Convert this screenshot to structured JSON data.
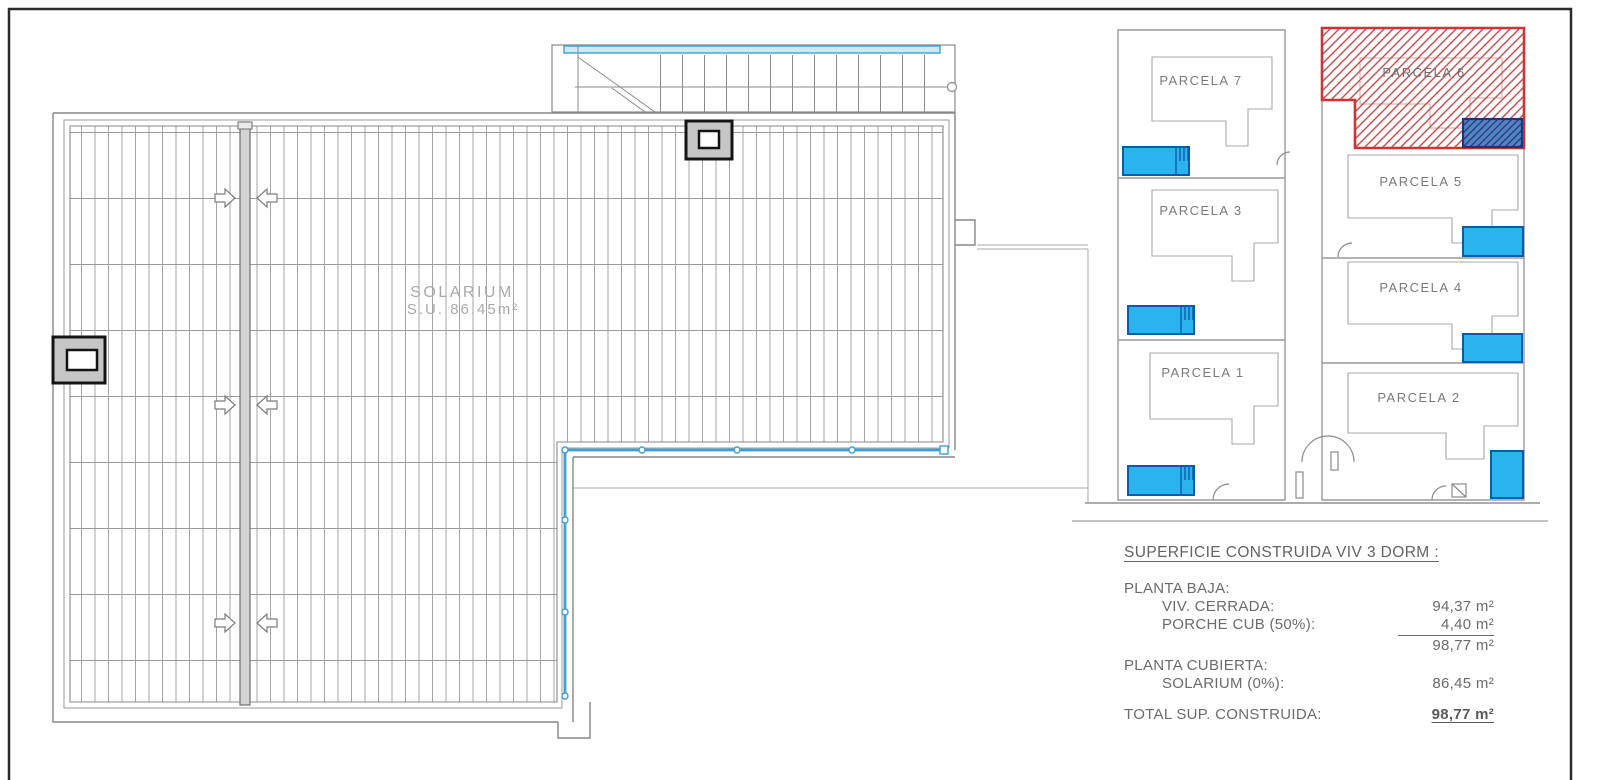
{
  "roof_plan": {
    "solarium_label": "SOLARIUM",
    "solarium_area": "S.U. 86.45m²"
  },
  "site_plan": {
    "parcela_7": "PARCELA 7",
    "parcela_3": "PARCELA 3",
    "parcela_1": "PARCELA 1",
    "parcela_6": "PARCELA 6",
    "parcela_5": "PARCELA 5",
    "parcela_4": "PARCELA 4",
    "parcela_2": "PARCELA 2",
    "highlighted_parcela": "PARCELA 6"
  },
  "summary": {
    "title": "SUPERFICIE CONSTRUIDA VIV 3 DORM :",
    "planta_baja_label": "PLANTA BAJA:",
    "viv_cerrada_label": "VIV. CERRADA:",
    "viv_cerrada_value": "94,37 m²",
    "porche_label": "PORCHE CUB (50%):",
    "porche_value": "4,40 m²",
    "subtotal_value": "98,77 m²",
    "planta_cubierta_label": "PLANTA CUBIERTA:",
    "solarium_label": "SOLARIUM (0%):",
    "solarium_value": "86,45 m²",
    "total_label": "TOTAL SUP. CONSTRUIDA:",
    "total_value": "98,77 m²"
  },
  "colors": {
    "pool_fill": "#29b4f0",
    "pool_border": "#0c5ba8",
    "highlight_red": "#ce3434",
    "p6_pool_fill": "#4f86c0",
    "p6_pool_border": "#28307d",
    "railing_blue": "#3d9fd6",
    "line_gray": "#8a8a8a",
    "text_gray": "#6b6b6b"
  }
}
